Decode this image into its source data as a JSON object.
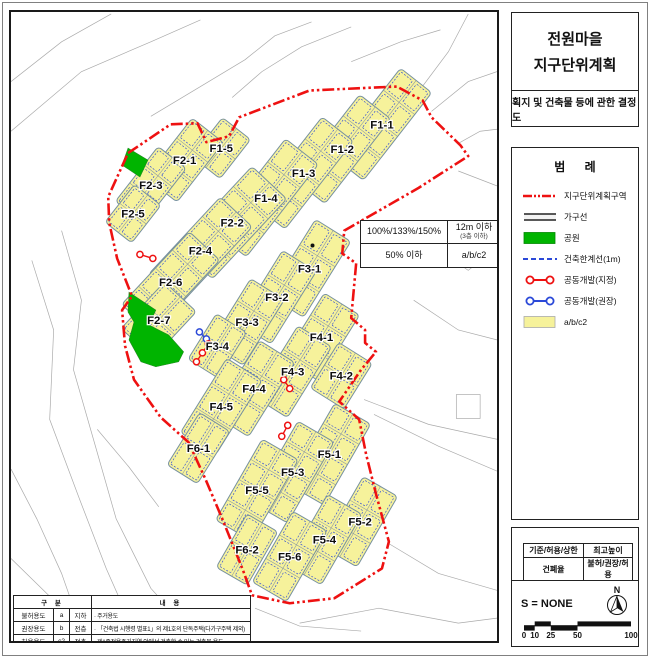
{
  "title_panel": {
    "title_line1": "전원마을",
    "title_line2": "지구단위계획",
    "subtitle": "획지 및 건축물 등에 관한 결정도"
  },
  "legend": {
    "title": "범 례",
    "items": [
      {
        "key": "district-boundary",
        "label": "지구단위계획구역",
        "color": "#ee1111"
      },
      {
        "key": "block-line",
        "label": "가구선",
        "color": "#222222"
      },
      {
        "key": "park",
        "label": "공원",
        "color": "#00b400"
      },
      {
        "key": "building-limit",
        "label": "건축한계선(1m)",
        "color": "#2b49d8"
      },
      {
        "key": "joint-dev-designated",
        "label": "공동개발(지정)",
        "color": "#ee1111"
      },
      {
        "key": "joint-dev-recommended",
        "label": "공동개발(권장)",
        "color": "#2b49d8"
      },
      {
        "key": "use-zone",
        "label": "a/b/c2",
        "color": "#f6f29b"
      }
    ]
  },
  "zoning_box": {
    "floor_area_ratio": "100%/133%/150%",
    "max_height": "12m 이하",
    "max_height_sub": "(3층 이하)",
    "coverage": "50% 이하",
    "uses": "a/b/c2"
  },
  "use_table": {
    "header_left": "구 분",
    "header_right": "내 용",
    "rows": [
      [
        "불허용도",
        "a",
        "지하",
        "· 주거용도"
      ],
      [
        "권장용도",
        "b",
        "전층",
        "· 「건축법 시행령 별표1」의 제1호의 단독주택(다가구주택 제외)"
      ],
      [
        "허용용도",
        "c2",
        "전층",
        "· 제1종전용주거지역 안에서 건축할 수 있는 건축물 용도"
      ]
    ]
  },
  "info_panel": {
    "matrix": {
      "r1c1": "기준/허용/상한",
      "r1c2": "최고높이",
      "r2c1": "건폐율",
      "r2c2": "불허/권장/허용"
    },
    "scale_text": "S = NONE",
    "north_label": "N",
    "scalebar_labels": [
      "0",
      "10",
      "25",
      "50",
      "100"
    ]
  },
  "map": {
    "colors": {
      "block_fill": "#f6f29b",
      "block_stroke": "#76909e",
      "lot_line": "#8795a3",
      "limit_line": "#2b49d8",
      "boundary": "#ee1111",
      "park": "#00b400",
      "joint_red": "#ee1111",
      "joint_blue": "#2b49d8"
    },
    "blocks": [
      {
        "id": "F1-1",
        "cx": 383,
        "cy": 123,
        "l": 112,
        "w": 40,
        "rot": -52,
        "cols": 4
      },
      {
        "id": "F1-2",
        "cx": 343,
        "cy": 148,
        "l": 108,
        "w": 40,
        "rot": -52,
        "cols": 4
      },
      {
        "id": "F1-3",
        "cx": 304,
        "cy": 172,
        "l": 112,
        "w": 40,
        "rot": -52,
        "cols": 4
      },
      {
        "id": "F1-4",
        "cx": 266,
        "cy": 197,
        "l": 118,
        "w": 42,
        "rot": -52,
        "cols": 4
      },
      {
        "id": "F1-5",
        "cx": 221,
        "cy": 147,
        "l": 50,
        "w": 36,
        "rot": -52,
        "cols": 2
      },
      {
        "id": "F2-1",
        "cx": 184,
        "cy": 159,
        "l": 76,
        "w": 40,
        "rot": -52,
        "cols": 3
      },
      {
        "id": "F2-3",
        "cx": 150,
        "cy": 184,
        "l": 70,
        "w": 36,
        "rot": -52,
        "cols": 3
      },
      {
        "id": "F2-5",
        "cx": 132,
        "cy": 213,
        "l": 48,
        "w": 34,
        "rot": -52,
        "cols": 2
      },
      {
        "id": "F2-2",
        "cx": 232,
        "cy": 222,
        "l": 110,
        "w": 48,
        "rot": -47,
        "cols": 4
      },
      {
        "id": "F2-4",
        "cx": 200,
        "cy": 250,
        "l": 106,
        "w": 44,
        "rot": -47,
        "cols": 4
      },
      {
        "id": "F2-6",
        "cx": 170,
        "cy": 282,
        "l": 100,
        "w": 42,
        "rot": -47,
        "cols": 4
      },
      {
        "id": "F2-7",
        "cx": 158,
        "cy": 320,
        "l": 64,
        "w": 44,
        "rot": -47,
        "cols": 2
      },
      {
        "id": "F3-1",
        "cx": 310,
        "cy": 268,
        "l": 90,
        "w": 42,
        "rot": -58,
        "cols": 3
      },
      {
        "id": "F3-2",
        "cx": 277,
        "cy": 297,
        "l": 86,
        "w": 40,
        "rot": -58,
        "cols": 3
      },
      {
        "id": "F3-3",
        "cx": 247,
        "cy": 322,
        "l": 78,
        "w": 40,
        "rot": -58,
        "cols": 3
      },
      {
        "id": "F3-4",
        "cx": 217,
        "cy": 346,
        "l": 54,
        "w": 36,
        "rot": -58,
        "cols": 2
      },
      {
        "id": "F4-1",
        "cx": 322,
        "cy": 337,
        "l": 78,
        "w": 42,
        "rot": -58,
        "cols": 3
      },
      {
        "id": "F4-2",
        "cx": 342,
        "cy": 376,
        "l": 54,
        "w": 40,
        "rot": -58,
        "cols": 2
      },
      {
        "id": "F4-3",
        "cx": 293,
        "cy": 372,
        "l": 84,
        "w": 40,
        "rot": -58,
        "cols": 3
      },
      {
        "id": "F4-4",
        "cx": 254,
        "cy": 389,
        "l": 88,
        "w": 42,
        "rot": -58,
        "cols": 3
      },
      {
        "id": "F4-5",
        "cx": 221,
        "cy": 407,
        "l": 88,
        "w": 42,
        "rot": -58,
        "cols": 3
      },
      {
        "id": "F6-1",
        "cx": 198,
        "cy": 449,
        "l": 62,
        "w": 36,
        "rot": -58,
        "cols": 2
      },
      {
        "id": "F5-1",
        "cx": 330,
        "cy": 455,
        "l": 94,
        "w": 42,
        "rot": -60,
        "cols": 4
      },
      {
        "id": "F5-3",
        "cx": 293,
        "cy": 473,
        "l": 94,
        "w": 42,
        "rot": -60,
        "cols": 4
      },
      {
        "id": "F5-5",
        "cx": 257,
        "cy": 491,
        "l": 94,
        "w": 42,
        "rot": -60,
        "cols": 4
      },
      {
        "id": "F5-2",
        "cx": 361,
        "cy": 523,
        "l": 82,
        "w": 40,
        "rot": -60,
        "cols": 3
      },
      {
        "id": "F5-4",
        "cx": 325,
        "cy": 541,
        "l": 82,
        "w": 40,
        "rot": -60,
        "cols": 3
      },
      {
        "id": "F5-6",
        "cx": 290,
        "cy": 558,
        "l": 82,
        "w": 40,
        "rot": -60,
        "cols": 3
      },
      {
        "id": "F6-2",
        "cx": 247,
        "cy": 551,
        "l": 62,
        "w": 36,
        "rot": -60,
        "cols": 2
      }
    ],
    "parks": [
      {
        "name": "park-small",
        "points": "127,147 147,159 139,176 121,164"
      },
      {
        "name": "park-large",
        "points": "128,292 155,310 148,325 168,335 183,352 178,362 155,367 140,362 128,340 133,322 127,312"
      }
    ],
    "boundary": "127,152 170,123 197,122 206,141 229,135 239,116 310,89 398,85 424,99 433,116 462,144 470,155 420,187 345,230 343,253 357,263 352,318 366,330 366,343 377,352 362,370 340,402 360,420 367,455 377,495 390,543 383,570 335,600 290,605 252,597 243,572 222,520 205,480 188,443 160,418 133,380 124,346 121,310 131,296 116,258 108,222 107,196",
    "joint_dev": [
      {
        "type": "designated",
        "color": "#ee1111",
        "points": [
          [
            139,
            254
          ],
          [
            152,
            258
          ]
        ]
      },
      {
        "type": "recommended",
        "color": "#2b49d8",
        "points": [
          [
            199,
            332
          ],
          [
            206,
            339
          ]
        ]
      },
      {
        "type": "designated",
        "color": "#ee1111",
        "points": [
          [
            208,
            344
          ],
          [
            202,
            353
          ],
          [
            196,
            362
          ]
        ]
      },
      {
        "type": "designated",
        "color": "#ee1111",
        "points": [
          [
            284,
            380
          ],
          [
            290,
            389
          ]
        ]
      },
      {
        "type": "designated",
        "color": "#ee1111",
        "points": [
          [
            288,
            426
          ],
          [
            282,
            437
          ]
        ]
      }
    ],
    "dots": [
      [
        313,
        245
      ]
    ]
  }
}
